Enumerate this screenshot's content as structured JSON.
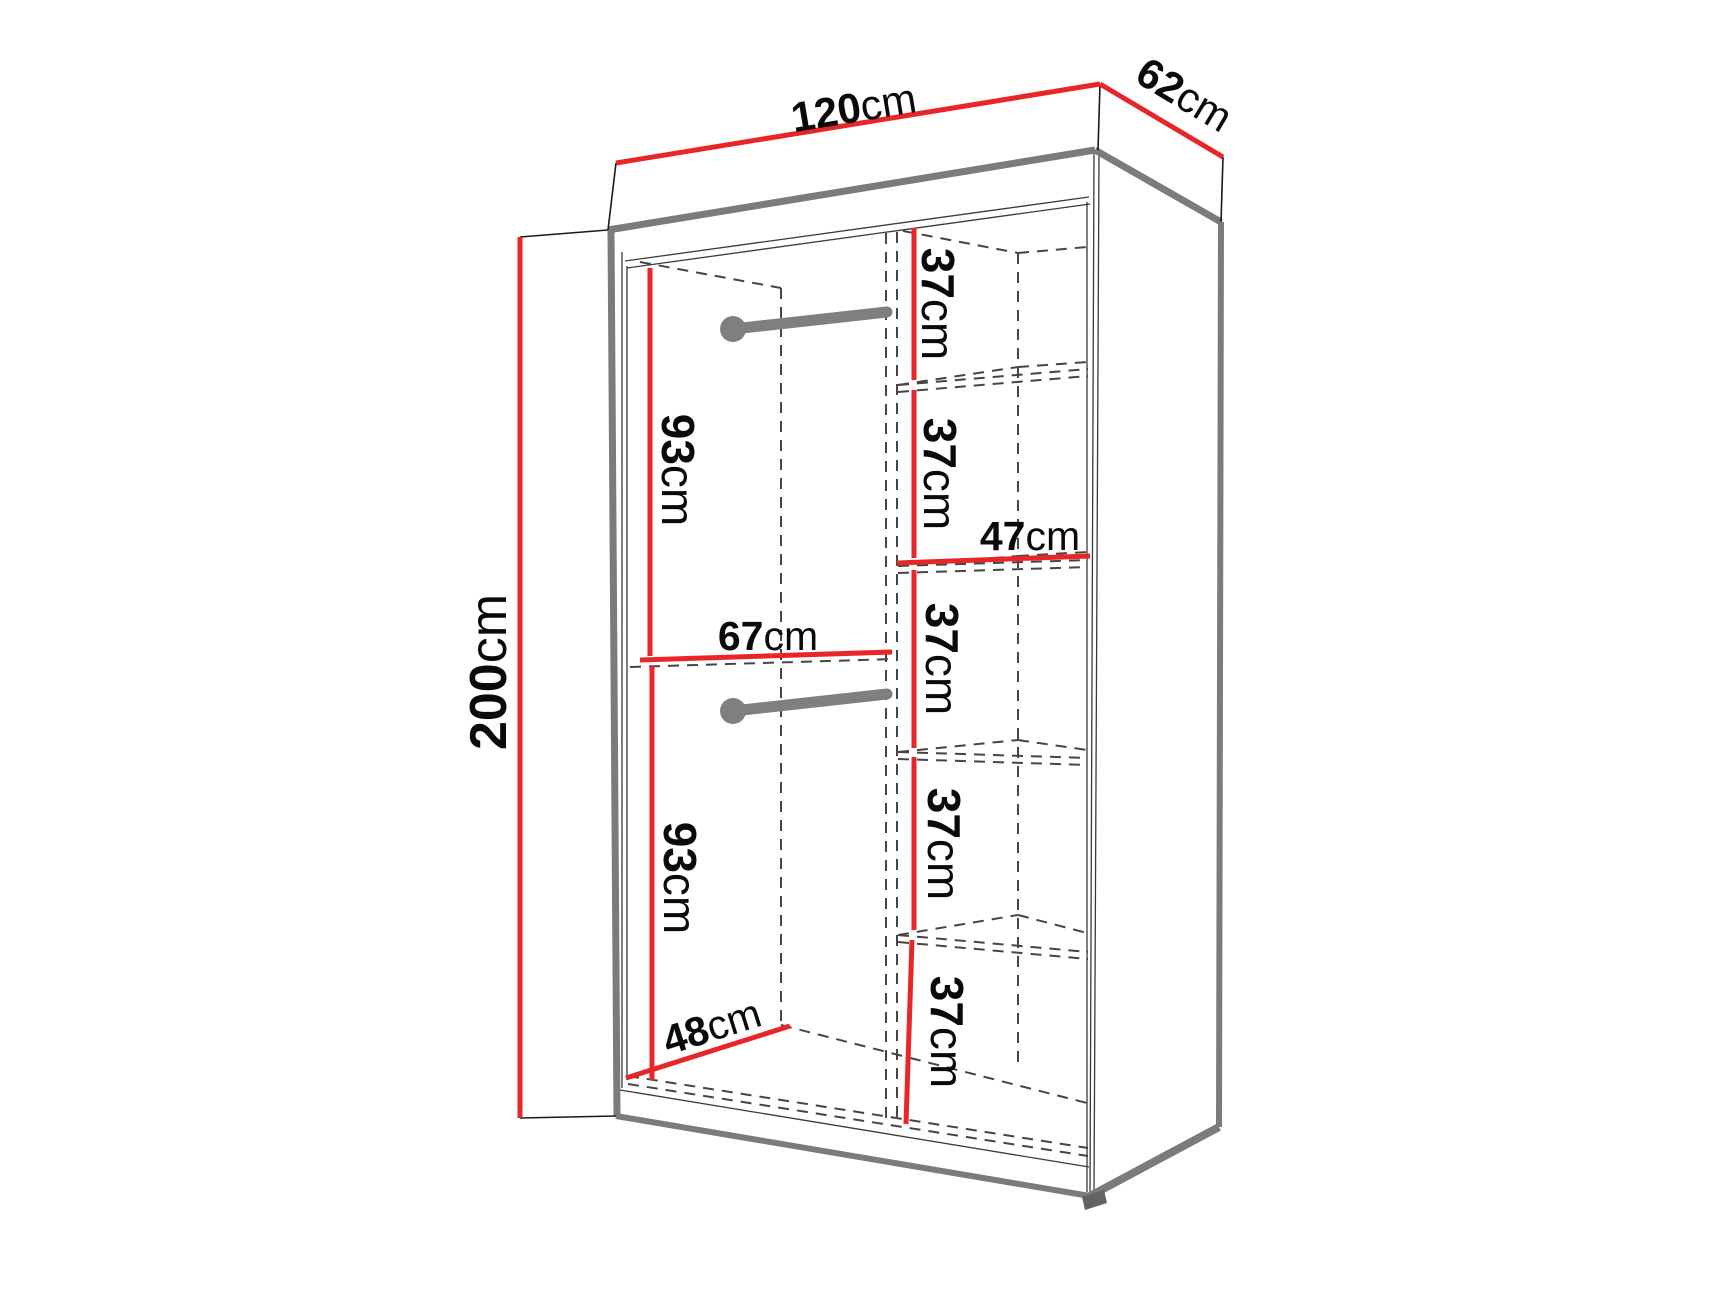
{
  "page": {
    "background": "#ffffff"
  },
  "colors": {
    "dimension_red": "#e8262a",
    "edge_gray": "#7b7b7b",
    "outline_black": "#1a1a1a",
    "hidden_line_gray": "#454545",
    "rail_gray": "#7f7f7f",
    "text_black": "#0a0a0a"
  },
  "diagram": {
    "name": "wardrobe-dimension-diagram",
    "overall": {
      "width": {
        "value": "120",
        "unit": "cm"
      },
      "depth": {
        "value": "62",
        "unit": "cm"
      },
      "height": {
        "value": "200",
        "unit": "cm"
      }
    },
    "left_compartment": {
      "upper_section_height": {
        "value": "93",
        "unit": "cm"
      },
      "lower_section_height": {
        "value": "93",
        "unit": "cm"
      },
      "width": {
        "value": "67",
        "unit": "cm"
      },
      "depth": {
        "value": "48",
        "unit": "cm"
      }
    },
    "shelf_column": {
      "shelf_width": {
        "value": "47",
        "unit": "cm"
      },
      "shelf_spacings": [
        {
          "value": "37",
          "unit": "cm"
        },
        {
          "value": "37",
          "unit": "cm"
        },
        {
          "value": "37",
          "unit": "cm"
        },
        {
          "value": "37",
          "unit": "cm"
        },
        {
          "value": "37",
          "unit": "cm"
        }
      ]
    }
  }
}
